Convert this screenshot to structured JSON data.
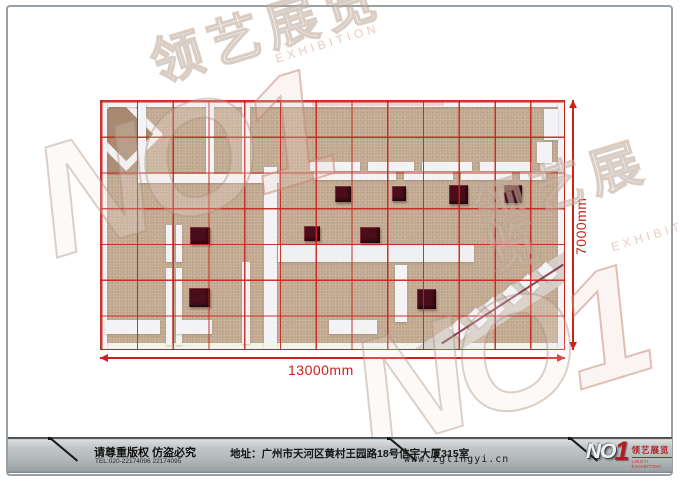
{
  "plan": {
    "width_label": "13000mm",
    "height_label": "7000mm",
    "grid": {
      "cols": 13,
      "rows": 7,
      "color": "rgba(200,32,26,0.9)"
    },
    "elements": [
      {
        "type": "patch",
        "name": "floor-dark-corner",
        "x": 7,
        "y": 7,
        "w": 32,
        "h": 68,
        "color": "#ab8e74"
      },
      {
        "type": "patch",
        "name": "diagonal-room-wall",
        "x": -10,
        "y": 4,
        "w": 64,
        "h": 52,
        "rot": 45,
        "color": "#f2f1f3"
      },
      {
        "type": "patch",
        "name": "diagonal-room-floor",
        "x": -3,
        "y": 11,
        "w": 50,
        "h": 38,
        "rot": 45,
        "color": "#a78a70"
      },
      {
        "type": "wall",
        "name": "outer-wall-top",
        "x": 0,
        "y": 0,
        "w": 465,
        "h": 7
      },
      {
        "type": "patch",
        "name": "top-wall-pink-band",
        "x": 212,
        "y": 0,
        "w": 132,
        "h": 6,
        "color": "#ecd2d4"
      },
      {
        "type": "wall",
        "name": "outer-wall-bottom",
        "x": 0,
        "y": 243,
        "w": 465,
        "h": 7
      },
      {
        "type": "wall",
        "name": "outer-wall-left",
        "x": 0,
        "y": 0,
        "w": 7,
        "h": 250
      },
      {
        "type": "wall",
        "name": "outer-wall-right",
        "x": 458,
        "y": 0,
        "w": 7,
        "h": 250
      },
      {
        "type": "wall",
        "x": 38,
        "y": 0,
        "w": 8,
        "h": 81
      },
      {
        "type": "wall",
        "x": 106,
        "y": 0,
        "w": 8,
        "h": 81
      },
      {
        "type": "wall",
        "x": 142,
        "y": 0,
        "w": 8,
        "h": 81
      },
      {
        "type": "wall",
        "x": 37,
        "y": 74,
        "w": 142,
        "h": 9
      },
      {
        "type": "wall",
        "name": "center-corridor",
        "x": 164,
        "y": 67,
        "w": 13,
        "h": 183
      },
      {
        "type": "wall",
        "x": 210,
        "y": 62,
        "w": 50,
        "h": 9
      },
      {
        "type": "wall",
        "x": 268,
        "y": 62,
        "w": 46,
        "h": 9
      },
      {
        "type": "wall",
        "x": 322,
        "y": 62,
        "w": 50,
        "h": 9
      },
      {
        "type": "wall",
        "x": 380,
        "y": 62,
        "w": 52,
        "h": 9
      },
      {
        "type": "wall",
        "x": 440,
        "y": 62,
        "w": 18,
        "h": 9
      },
      {
        "type": "wall",
        "x": 214,
        "y": 72,
        "w": 82,
        "h": 8
      },
      {
        "type": "wall",
        "x": 304,
        "y": 72,
        "w": 49,
        "h": 8
      },
      {
        "type": "wall",
        "x": 361,
        "y": 72,
        "w": 51,
        "h": 8
      },
      {
        "type": "wall",
        "x": 420,
        "y": 72,
        "w": 26,
        "h": 8
      },
      {
        "type": "wall",
        "name": "right-alcove-upper",
        "x": 444,
        "y": 9,
        "w": 14,
        "h": 31
      },
      {
        "type": "wall",
        "name": "right-alcove-lower",
        "x": 437,
        "y": 42,
        "w": 15,
        "h": 21
      },
      {
        "type": "wall",
        "name": "walkway",
        "x": 178,
        "y": 145,
        "w": 196,
        "h": 17,
        "color": "#eef0f1"
      },
      {
        "type": "wall",
        "x": 66,
        "y": 125,
        "w": 6,
        "h": 37
      },
      {
        "type": "wall",
        "x": 76,
        "y": 125,
        "w": 6,
        "h": 37
      },
      {
        "type": "wall",
        "x": 66,
        "y": 168,
        "w": 6,
        "h": 77
      },
      {
        "type": "wall",
        "x": 76,
        "y": 168,
        "w": 6,
        "h": 77
      },
      {
        "type": "wall",
        "x": 142,
        "y": 162,
        "w": 8,
        "h": 82
      },
      {
        "type": "wall",
        "x": 295,
        "y": 165,
        "w": 12,
        "h": 57
      },
      {
        "type": "wall",
        "x": 5,
        "y": 220,
        "w": 55,
        "h": 14
      },
      {
        "type": "wall",
        "x": 76,
        "y": 220,
        "w": 36,
        "h": 14
      },
      {
        "type": "wall",
        "x": 229,
        "y": 220,
        "w": 48,
        "h": 14
      },
      {
        "type": "patch",
        "name": "diagonal-walkway",
        "x": 300,
        "y": 196,
        "w": 200,
        "h": 26,
        "rot": -33,
        "color": "#d6d0c9",
        "op": 0.95
      },
      {
        "type": "wall",
        "name": "zigzag-panel",
        "x": 351,
        "y": 224,
        "w": 17,
        "h": 12,
        "rot": 45
      },
      {
        "type": "wall",
        "name": "zigzag-panel",
        "x": 369,
        "y": 212,
        "w": 17,
        "h": 12,
        "rot": 45
      },
      {
        "type": "wall",
        "name": "zigzag-panel",
        "x": 386,
        "y": 201,
        "w": 17,
        "h": 12,
        "rot": 45
      },
      {
        "type": "wall",
        "name": "zigzag-panel",
        "x": 404,
        "y": 189,
        "w": 17,
        "h": 12,
        "rot": 45
      },
      {
        "type": "wall",
        "name": "zigzag-panel",
        "x": 421,
        "y": 178,
        "w": 17,
        "h": 12,
        "rot": 45
      },
      {
        "type": "wall",
        "name": "zigzag-panel",
        "x": 439,
        "y": 166,
        "w": 17,
        "h": 12,
        "rot": 45
      },
      {
        "type": "patch",
        "name": "diagonal-rail",
        "x": 330,
        "y": 203,
        "w": 145,
        "h": 2,
        "rot": -33,
        "color": "#6a1425",
        "op": 0.75
      },
      {
        "type": "box",
        "name": "display-box",
        "x": 235,
        "y": 86,
        "w": 16,
        "h": 16
      },
      {
        "type": "box",
        "name": "display-box",
        "x": 292,
        "y": 86,
        "w": 14,
        "h": 15
      },
      {
        "type": "box",
        "name": "display-box",
        "x": 349,
        "y": 85,
        "w": 19,
        "h": 19
      },
      {
        "type": "box",
        "name": "display-box",
        "x": 404,
        "y": 85,
        "w": 18,
        "h": 18
      },
      {
        "type": "box",
        "name": "display-box",
        "x": 90,
        "y": 127,
        "w": 20,
        "h": 17
      },
      {
        "type": "box",
        "name": "display-box",
        "x": 204,
        "y": 126,
        "w": 16,
        "h": 15
      },
      {
        "type": "box",
        "name": "display-box",
        "x": 260,
        "y": 127,
        "w": 20,
        "h": 16
      },
      {
        "type": "box",
        "name": "display-box",
        "x": 89,
        "y": 188,
        "w": 21,
        "h": 19
      },
      {
        "type": "box",
        "name": "display-box",
        "x": 317,
        "y": 189,
        "w": 19,
        "h": 20
      }
    ]
  },
  "watermarks": [
    {
      "cn": "领艺展览",
      "en": "EXHIBITION",
      "no": "NO",
      "one": "1"
    },
    {
      "cn": "领艺展览",
      "en": "EXHIBITION",
      "no": "NO",
      "one": "1"
    }
  ],
  "footer": {
    "copyright": "请尊重版权 仿盗必究",
    "tel": "TEL:020-22174096 22174095",
    "address": "地址：广州市天河区黄村王园路18号信宇大厦315室",
    "website": "www.zglingyi.cn",
    "logo": {
      "no": "NO",
      "one": "1",
      "cn": "领艺展览",
      "en": "LINGYI EXHIBITION"
    }
  }
}
